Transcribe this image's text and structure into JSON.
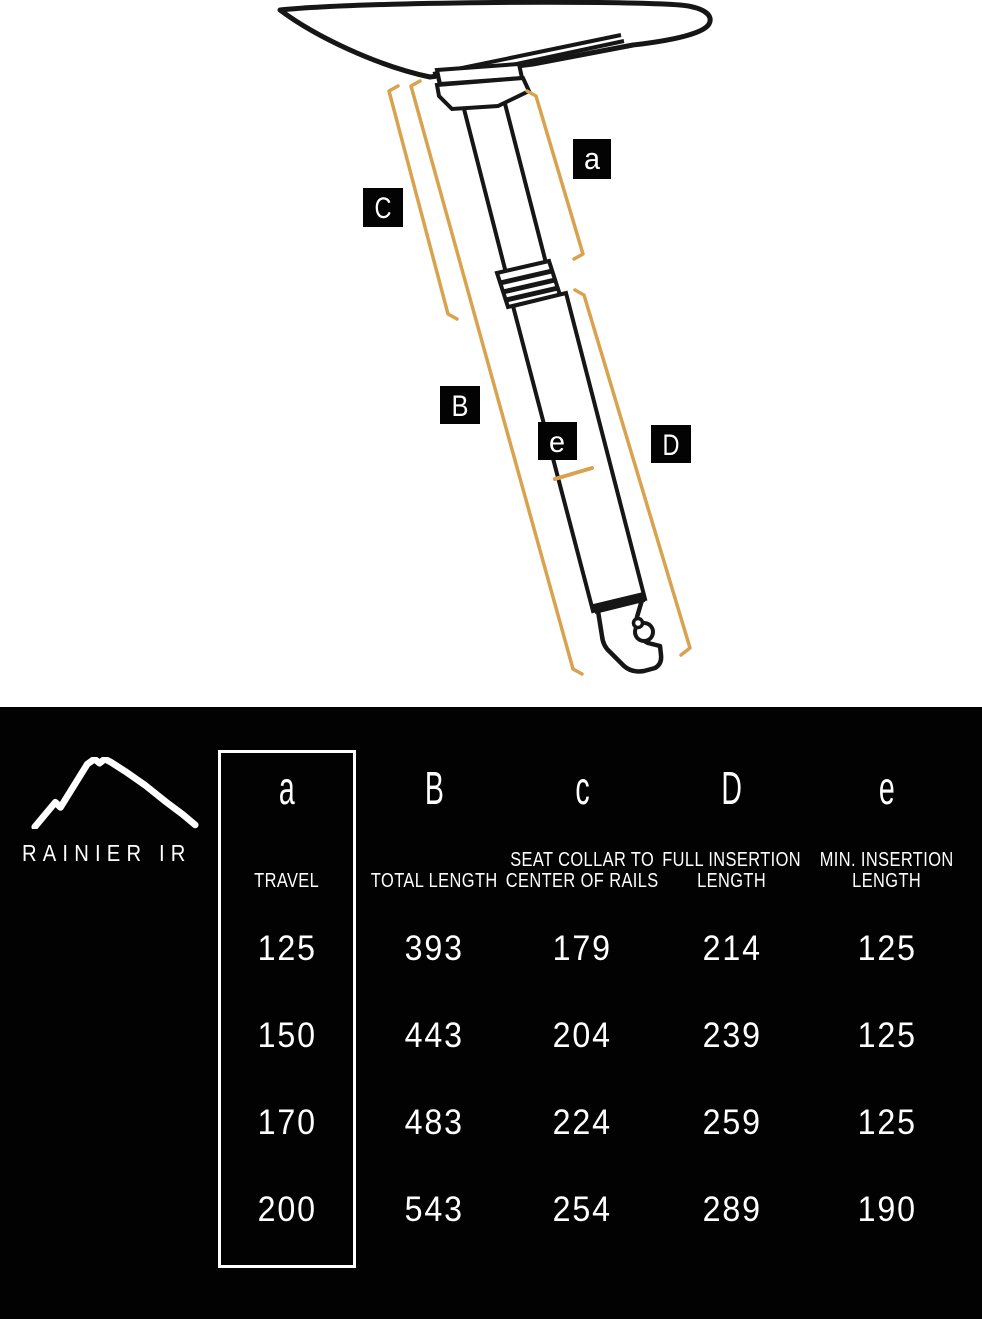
{
  "brand": {
    "name": "RAINIER IR"
  },
  "colors": {
    "accent_orange": "#D9A24F",
    "line_black": "#161616",
    "panel_background": "#020202",
    "text_white": "#FFFFFF"
  },
  "diagram": {
    "labels": [
      {
        "letter": "a"
      },
      {
        "letter": "C"
      },
      {
        "letter": "B"
      },
      {
        "letter": "e"
      },
      {
        "letter": "D"
      }
    ]
  },
  "table": {
    "columns": [
      {
        "letter": "a",
        "title_lines": [
          "TRAVEL"
        ],
        "highlighted": true
      },
      {
        "letter": "B",
        "title_lines": [
          "TOTAL LENGTH"
        ],
        "highlighted": false
      },
      {
        "letter": "c",
        "title_lines": [
          "SEAT COLLAR TO",
          "CENTER OF RAILS"
        ],
        "highlighted": false
      },
      {
        "letter": "D",
        "title_lines": [
          "FULL INSERTION",
          "LENGTH"
        ],
        "highlighted": false
      },
      {
        "letter": "e",
        "title_lines": [
          "MIN. INSERTION",
          "LENGTH"
        ],
        "highlighted": false
      }
    ],
    "rows": [
      [
        "125",
        "393",
        "179",
        "214",
        "125"
      ],
      [
        "150",
        "443",
        "204",
        "239",
        "125"
      ],
      [
        "170",
        "483",
        "224",
        "259",
        "125"
      ],
      [
        "200",
        "543",
        "254",
        "289",
        "190"
      ]
    ]
  }
}
